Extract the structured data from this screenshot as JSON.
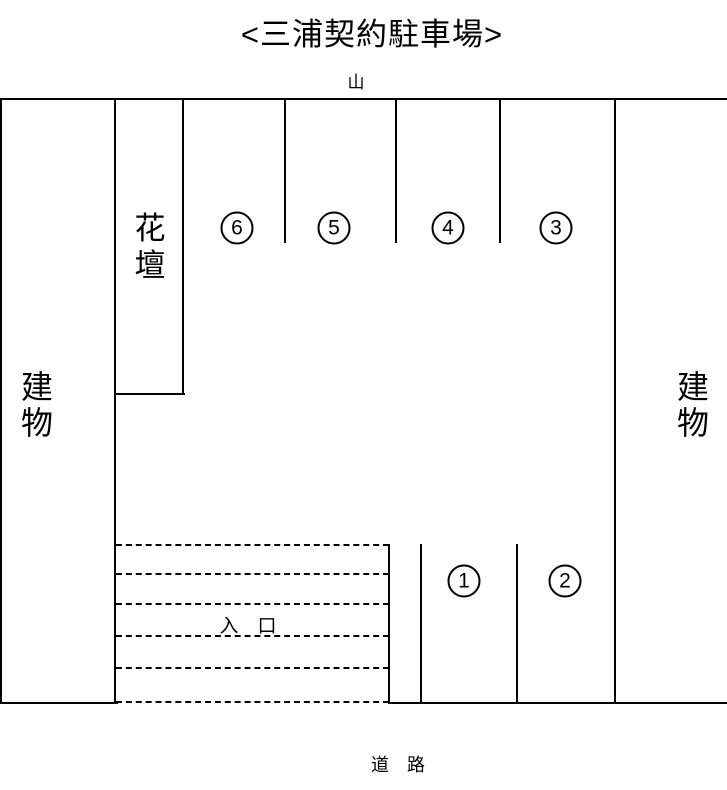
{
  "title": "<三浦契約駐車場>",
  "surroundings": {
    "top": "山",
    "left": "建物",
    "right": "建物",
    "bottom": "道　路"
  },
  "flower_bed": {
    "label": "花壇"
  },
  "entrance": {
    "label": "入　口"
  },
  "spots": {
    "top_row": [
      {
        "number": "6"
      },
      {
        "number": "5"
      },
      {
        "number": "4"
      },
      {
        "number": "3"
      }
    ],
    "bottom_row": [
      {
        "number": "1"
      },
      {
        "number": "2"
      }
    ]
  }
}
